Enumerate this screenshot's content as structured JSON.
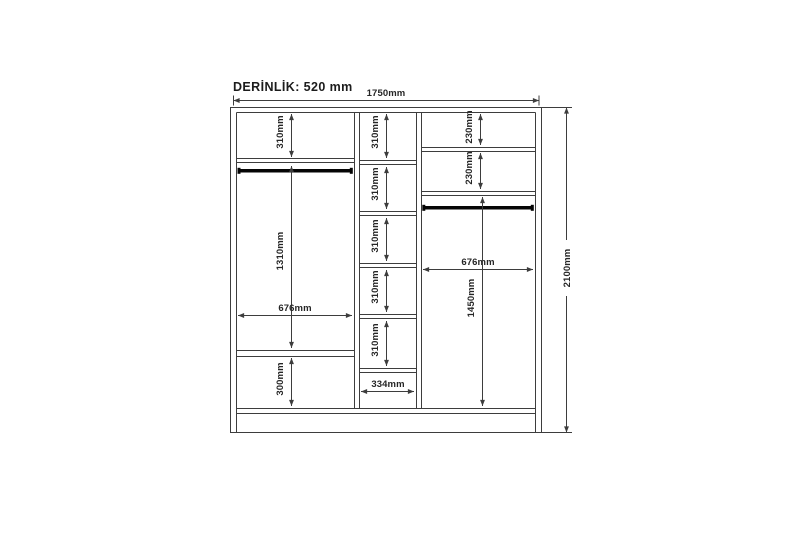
{
  "drawing": {
    "depth_label": "DERİNLİK: 520 mm",
    "overall": {
      "width": "1750mm",
      "height": "2100mm"
    },
    "left_section": {
      "top_compartment_height": "310mm",
      "hanging_area_height": "1310mm",
      "width": "676mm",
      "bottom_compartment_height": "300mm"
    },
    "middle_section": {
      "compartment_heights": [
        "310mm",
        "310mm",
        "310mm",
        "310mm",
        "310mm"
      ],
      "width": "334mm"
    },
    "right_section": {
      "compartment_1_height": "230mm",
      "compartment_2_height": "230mm",
      "width": "676mm",
      "hanging_area_height": "1450mm"
    }
  }
}
